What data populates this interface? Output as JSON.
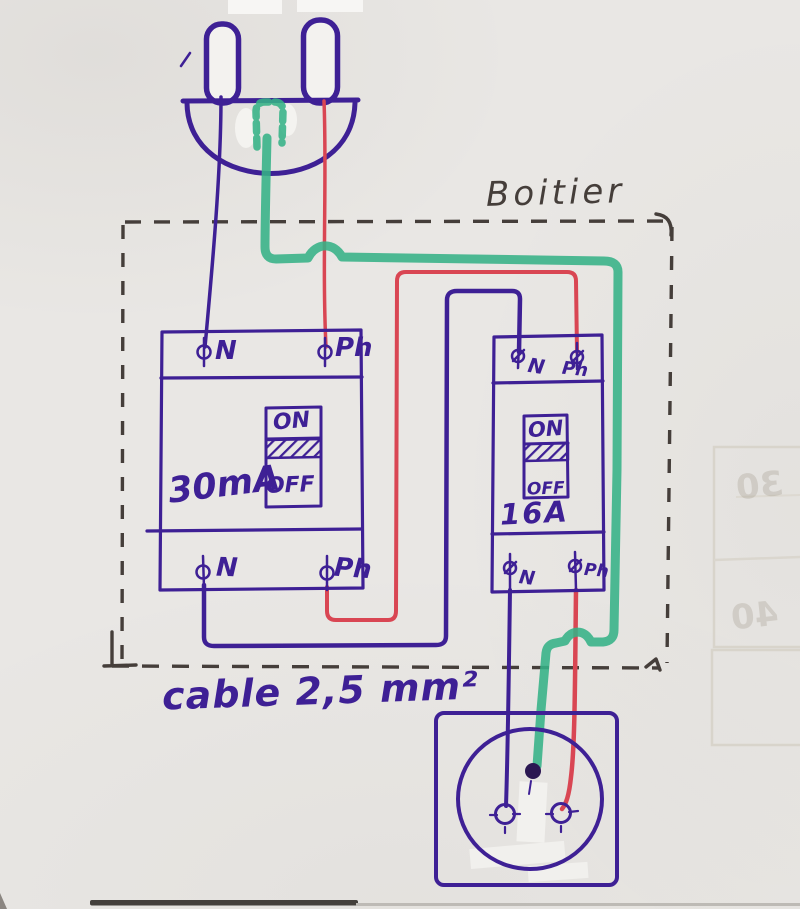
{
  "diagram": {
    "enclosure_label": "Boitier",
    "cable_label": "cable 2,5 mm²",
    "breaker_left": {
      "rating": "30mA",
      "on": "ON",
      "off": "OFF",
      "terminal_top_left": "N",
      "terminal_top_right": "Ph",
      "terminal_bottom_left": "N",
      "terminal_bottom_right": "Ph"
    },
    "breaker_right": {
      "rating": "16A",
      "on": "ON",
      "off": "OFF",
      "terminal_top_left": "N",
      "terminal_top_right": "Ph",
      "terminal_bottom_left": "N",
      "terminal_bottom_right": "Ph"
    },
    "ghost_bleedthrough": {
      "text_top": "30",
      "text_bottom": "40"
    },
    "colors": {
      "neutral": "#3e2095",
      "phase": "#d94653",
      "earth": "#35b286",
      "pencil": "#453e3a",
      "paper": "#e9e7e4"
    }
  }
}
